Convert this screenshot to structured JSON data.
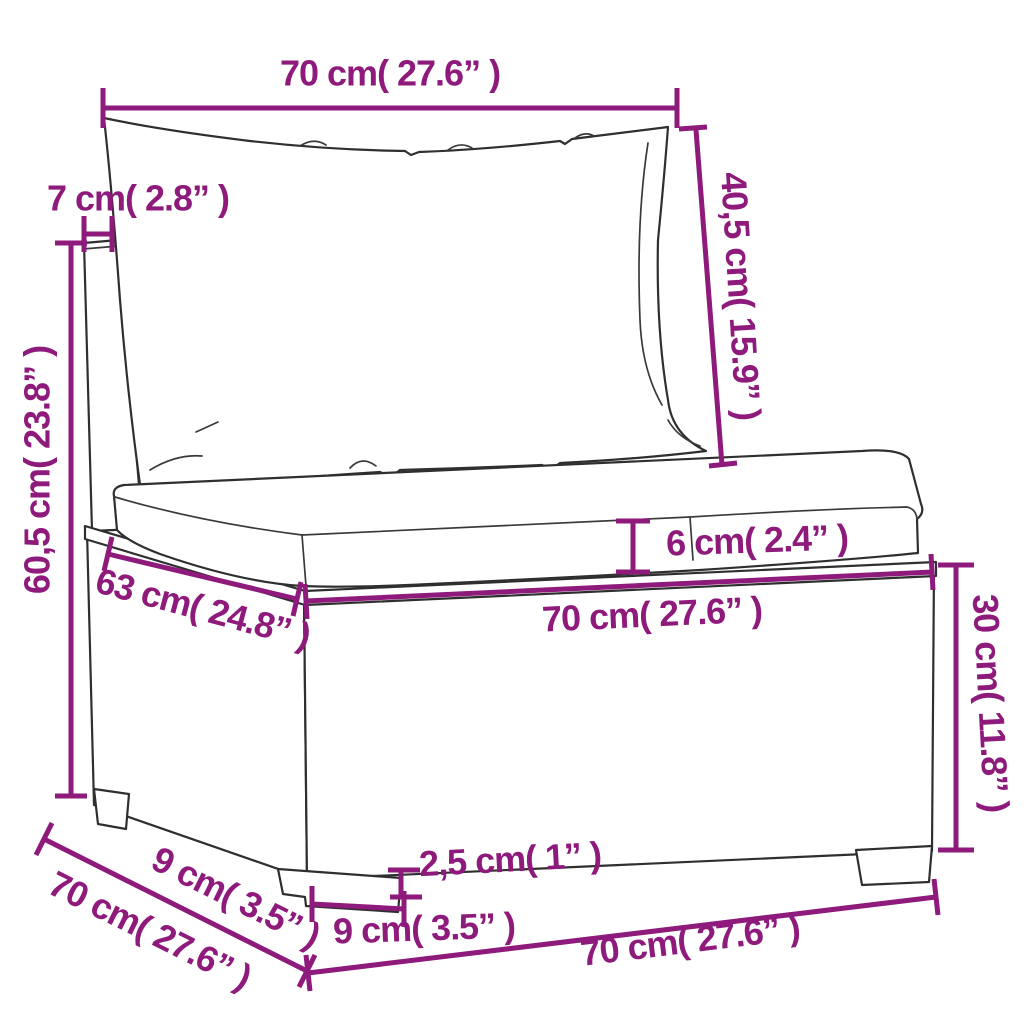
{
  "background": "#ffffff",
  "accent_color": "#8E1A7B",
  "line_color": "#2f2f2f",
  "dimensions": {
    "top_width": "70 cm( 27.6” )",
    "back_thickness": "7 cm( 2.8” )",
    "back_cushion_height": "40,5 cm( 15.9” )",
    "total_height": "60,5 cm( 23.8” )",
    "seat_cushion_thickness": "6 cm( 2.4” )",
    "seat_width": "70 cm( 27.6” )",
    "seat_depth": "63 cm( 24.8” )",
    "base_height": "30 cm( 11.8” )",
    "side_leg_inset": "9 cm( 3.5” )",
    "side_depth": "70 cm( 27.6” )",
    "leg_height": "2,5 cm( 1” )",
    "front_leg_width": "9 cm( 3.5” )",
    "bottom_width": "70 cm( 27.6” )"
  }
}
